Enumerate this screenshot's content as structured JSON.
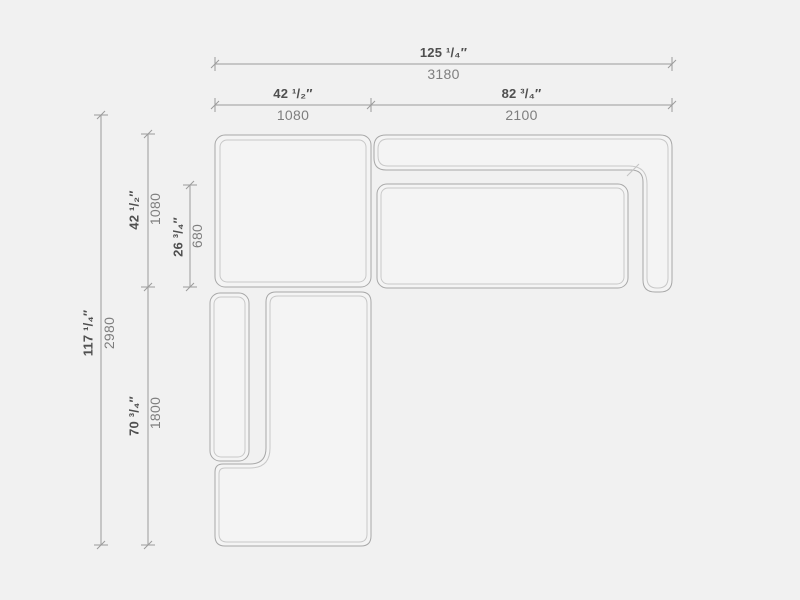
{
  "drawing": {
    "type": "sectional-sofa-top-view-technical-drawing",
    "colors": {
      "background": "#f1f1f1",
      "module_fill": "#f4f4f4",
      "outline_outer": "#a8a8a8",
      "outline_inner": "#c8c8c8",
      "dimension_line": "#9c9c9c",
      "inch_text": "#4f4f4f",
      "mm_text": "#7e7e7e"
    },
    "modules": [
      {
        "name": "corner-seat-module"
      },
      {
        "name": "right-sofa-back-and-arm"
      },
      {
        "name": "right-sofa-seat-cushion"
      },
      {
        "name": "chaise-module"
      },
      {
        "name": "chaise-arm-cushion"
      }
    ],
    "dimensions": {
      "total_width": {
        "inches": "125 ¹/₄″",
        "mm": "3180"
      },
      "left_width": {
        "inches": "42 ¹/₂″",
        "mm": "1080"
      },
      "right_width": {
        "inches": "82 ³/₄″",
        "mm": "2100"
      },
      "total_depth": {
        "inches": "117 ¹/₄″",
        "mm": "2980"
      },
      "upper_depth": {
        "inches": "42 ¹/₂″",
        "mm": "1080"
      },
      "seat_depth": {
        "inches": "26 ³/₄″",
        "mm": "680"
      },
      "lower_depth": {
        "inches": "70 ³/₄″",
        "mm": "1800"
      }
    }
  }
}
